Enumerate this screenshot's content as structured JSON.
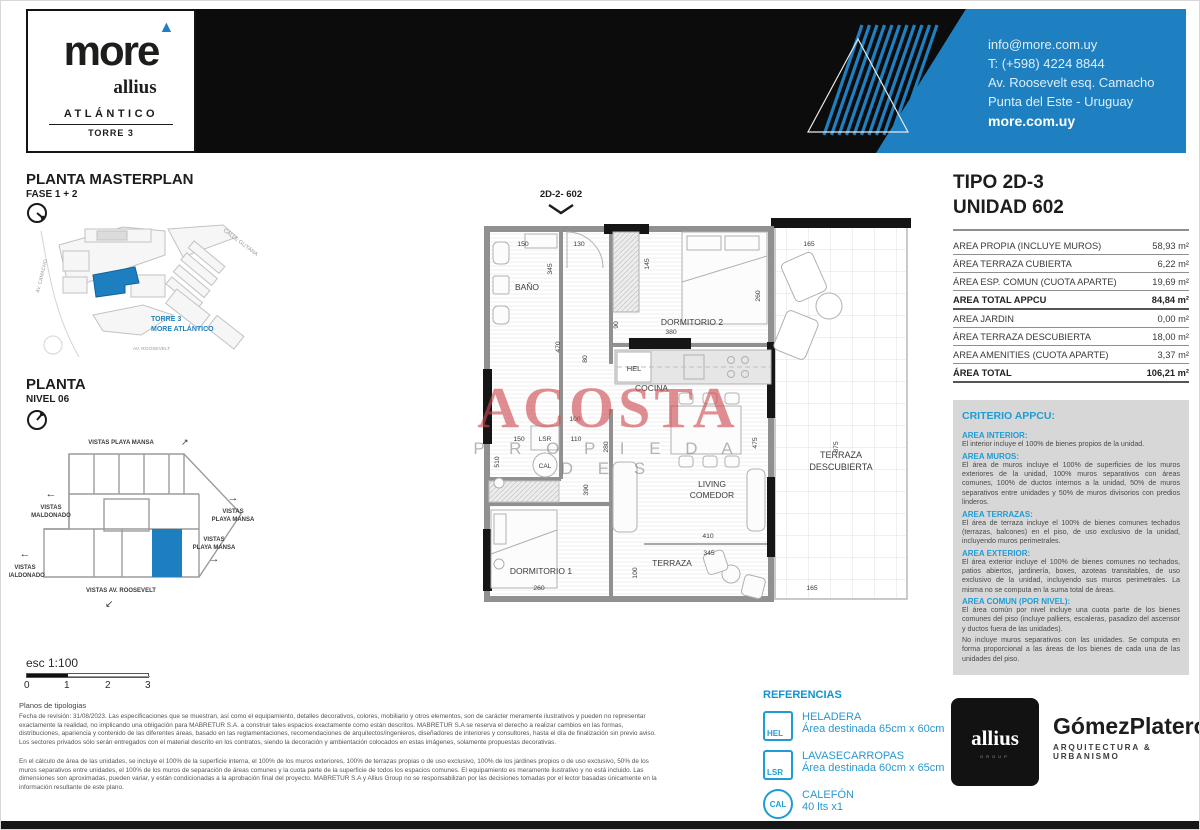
{
  "header": {
    "brand": "more",
    "brand_triangle": "▲",
    "sub_brand": "allius",
    "project": "ATLÁNTICO",
    "tower": "TORRE 3",
    "contact_email": "info@more.com.uy",
    "contact_phone": "T: (+598) 4224 8844",
    "contact_address1": "Av. Roosevelt esq. Camacho",
    "contact_address2": "Punta del Este - Uruguay",
    "contact_web": "more.com.uy"
  },
  "masterplan": {
    "title": "PLANTA MASTERPLAN",
    "subtitle": "FASE 1 + 2",
    "street_top": "CALLE GUYANA",
    "street_left": "AV. CAMACHO",
    "street_bottom": "AV. ROOSEVELT",
    "tower_label1": "TORRE 3",
    "tower_label2": "MORE ATLÁNTICO"
  },
  "level": {
    "title": "PLANTA",
    "subtitle": "NIVEL 06",
    "vista_top": "VISTAS PLAYA MANSA",
    "vista_left_upper1": "VISTAS",
    "vista_left_upper2": "MALDONADO",
    "vista_right1": "VISTAS",
    "vista_right2": "PLAYA MANSA",
    "vista_mid1": "VISTAS",
    "vista_mid2": "PLAYA MANSA",
    "vista_left_lower1": "VISTAS",
    "vista_left_lower2": "MALDONADO",
    "vista_bottom": "VISTAS AV. ROOSEVELT",
    "arrow_up_right": "↗",
    "arrow_left": "←",
    "arrow_right": "→",
    "arrow_down_left": "↙"
  },
  "plan": {
    "unit_label": "2D-2- 602",
    "rooms": {
      "bano": "BAÑO",
      "dorm2": "DORMITORIO 2",
      "cocina": "COCINA",
      "living1": "LIVING",
      "living2": "COMEDOR",
      "dorm1": "DORMITORIO 1",
      "terraza": "TERRAZA",
      "terraza_desc1": "TERRAZA",
      "terraza_desc2": "DESCUBIERTA",
      "hel": "HEL",
      "lsr": "LSR",
      "cal": "CAL"
    },
    "dims": {
      "banio_w": "150",
      "hall_w": "130",
      "banio_h": "345",
      "dorm2_l": "145",
      "tdesc_w": "165",
      "dorm2_r": "260",
      "dorm2_w": "380",
      "d90": "90",
      "d80": "80",
      "hall_h": "470",
      "patio_top": "100",
      "patio_w1": "150",
      "patio_w2": "110",
      "dorm1_l": "510",
      "living_l": "280",
      "dorm1_r": "390",
      "living_w": "410",
      "living_r": "475",
      "tdesc_h": "875",
      "terraza_w": "345",
      "terraza_h": "100",
      "tdesc_b": "165",
      "dorm1_w": "260"
    }
  },
  "watermark": {
    "line1": "ACOSTA",
    "line2": "P R O P I E D A D E S"
  },
  "unit": {
    "type_title": "TIPO 2D-3",
    "unit_title": "UNIDAD 602",
    "rows": [
      {
        "label": "AREA PROPIA (INCLUYE MUROS)",
        "value": "58,93 m²"
      },
      {
        "label": "ÁREA TERRAZA CUBIERTA",
        "value": "6,22 m²"
      },
      {
        "label": "ÁREA ESP. COMUN (CUOTA APARTE)",
        "value": "19,69 m²"
      },
      {
        "label": "AREA TOTAL APPCU",
        "value": "84,84 m²"
      },
      {
        "label": "AREA JARDIN",
        "value": "0,00 m²"
      },
      {
        "label": "ÁREA TERRAZA DESCUBIERTA",
        "value": "18,00 m²"
      },
      {
        "label": "AREA AMENITIES (CUOTA APARTE)",
        "value": "3,37 m²"
      },
      {
        "label": "ÁREA TOTAL",
        "value": "106,21 m²"
      }
    ]
  },
  "criterio": {
    "title": "CRITERIO APPCU:",
    "sections": [
      {
        "heading": "AREA INTERIOR:",
        "text": "El interior incluye el 100% de bienes propios de la unidad."
      },
      {
        "heading": "AREA MUROS:",
        "text": "El área de muros incluye el 100% de superficies de los muros exteriores de la unidad, 100% muros separativos con áreas comunes, 100% de ductos internos a la unidad, 50% de muros separativos entre unidades y 50% de muros divisorios con predios linderos."
      },
      {
        "heading": "AREA TERRAZAS:",
        "text": "El área de terraza incluye el 100% de bienes comunes techados (terrazas, balcones) en el piso, de uso exclusivo de la unidad, incluyendo muros perimetrales."
      },
      {
        "heading": "AREA EXTERIOR:",
        "text": "El área exterior incluye el 100% de bienes comunes no techados, patios abiertos, jardinería, boxes, azoteas transitables, de uso exclusivo de la unidad, incluyendo sus muros perimetrales. La misma no se computa en la suma total de áreas."
      },
      {
        "heading": "AREA COMUN (POR NIVEL):",
        "text": "El área común por nivel incluye una cuota parte de los bienes comunes del piso (incluye palliers, escaleras, pasadizo del ascensor y ductos fuera de las unidades).",
        "text2": "No incluye muros separativos con las unidades. Se computa en forma proporcional a las áreas de los bienes de cada una de las unidades del piso."
      }
    ]
  },
  "references": {
    "title": "REFERENCIAS",
    "items": [
      {
        "code": "HEL",
        "name": "HELADERA",
        "desc": "Área destinada 65cm x 60cm"
      },
      {
        "code": "LSR",
        "name": "LAVASECARROPAS",
        "desc": "Área destinada 60cm x 65cm"
      },
      {
        "code": "CAL",
        "name": "CALEFÓN",
        "desc": "40 lts x1"
      }
    ]
  },
  "scalebar": {
    "label": "esc 1:100",
    "ticks": [
      "0",
      "1",
      "2",
      "3"
    ]
  },
  "notes": {
    "title": "Planos de tipologias",
    "p1": "Fecha de revisión: 31/08/2023. Las especificaciones que se muestran, así como el equipamiento, detalles decorativos, colores, mobiliario y otros elementos, son de carácter meramente ilustrativos y pueden no representar exactamente la realidad, no implicando una obligación para MABRETUR S.A. a construir tales espacios exactamente como están descritos. MABRETUR S.A se reserva el derecho a realizar cambios en las formas, distribuciones, apariencia y contenido de las diferentes áreas, basado en las reglamentaciones, recomendaciones de arquitectos/ingenieros, diseñadores de interiores y consultores, hasta el día de finalización sin previo aviso. Los sectores privados sólo serán entregados con el material descrito en los contratos, siendo la decoración y ambientación colocados en estas imágenes, solamente propuestas decorativas.",
    "p2": "En el cálculo de área de las unidades, se incluye el 100% de la superficie interna, el 100% de los muros exteriores, 100% de terrazas propias o de uso exclusivo, 100% de los jardines propios o de uso exclusivo, 50% de los muros separativos entre unidades, el 100% de los muros de separación de áreas comunes y la cuota parte de la superficie de todos los espacios comunes. El equipamiento es meramente ilustrativo y no está incluido. Las dimensiones son aproximadas, pueden variar, y están condicionadas a la aprobación final del proyecto. MABRETUR S.A y Allius Group no se responsabilizan por las decisiones tomadas por el lector basadas únicamente en la información resultante de este plano."
  },
  "footer": {
    "allius": "allius",
    "allius_sub": "GROUP",
    "firm": "GómezPlatero",
    "firm_sub": "ARQUITECTURA & URBANISMO"
  },
  "colors": {
    "accent_blue": "#1f80c1",
    "criteria_blue": "#1e9cd6",
    "watermark_red": "#cd484e"
  }
}
